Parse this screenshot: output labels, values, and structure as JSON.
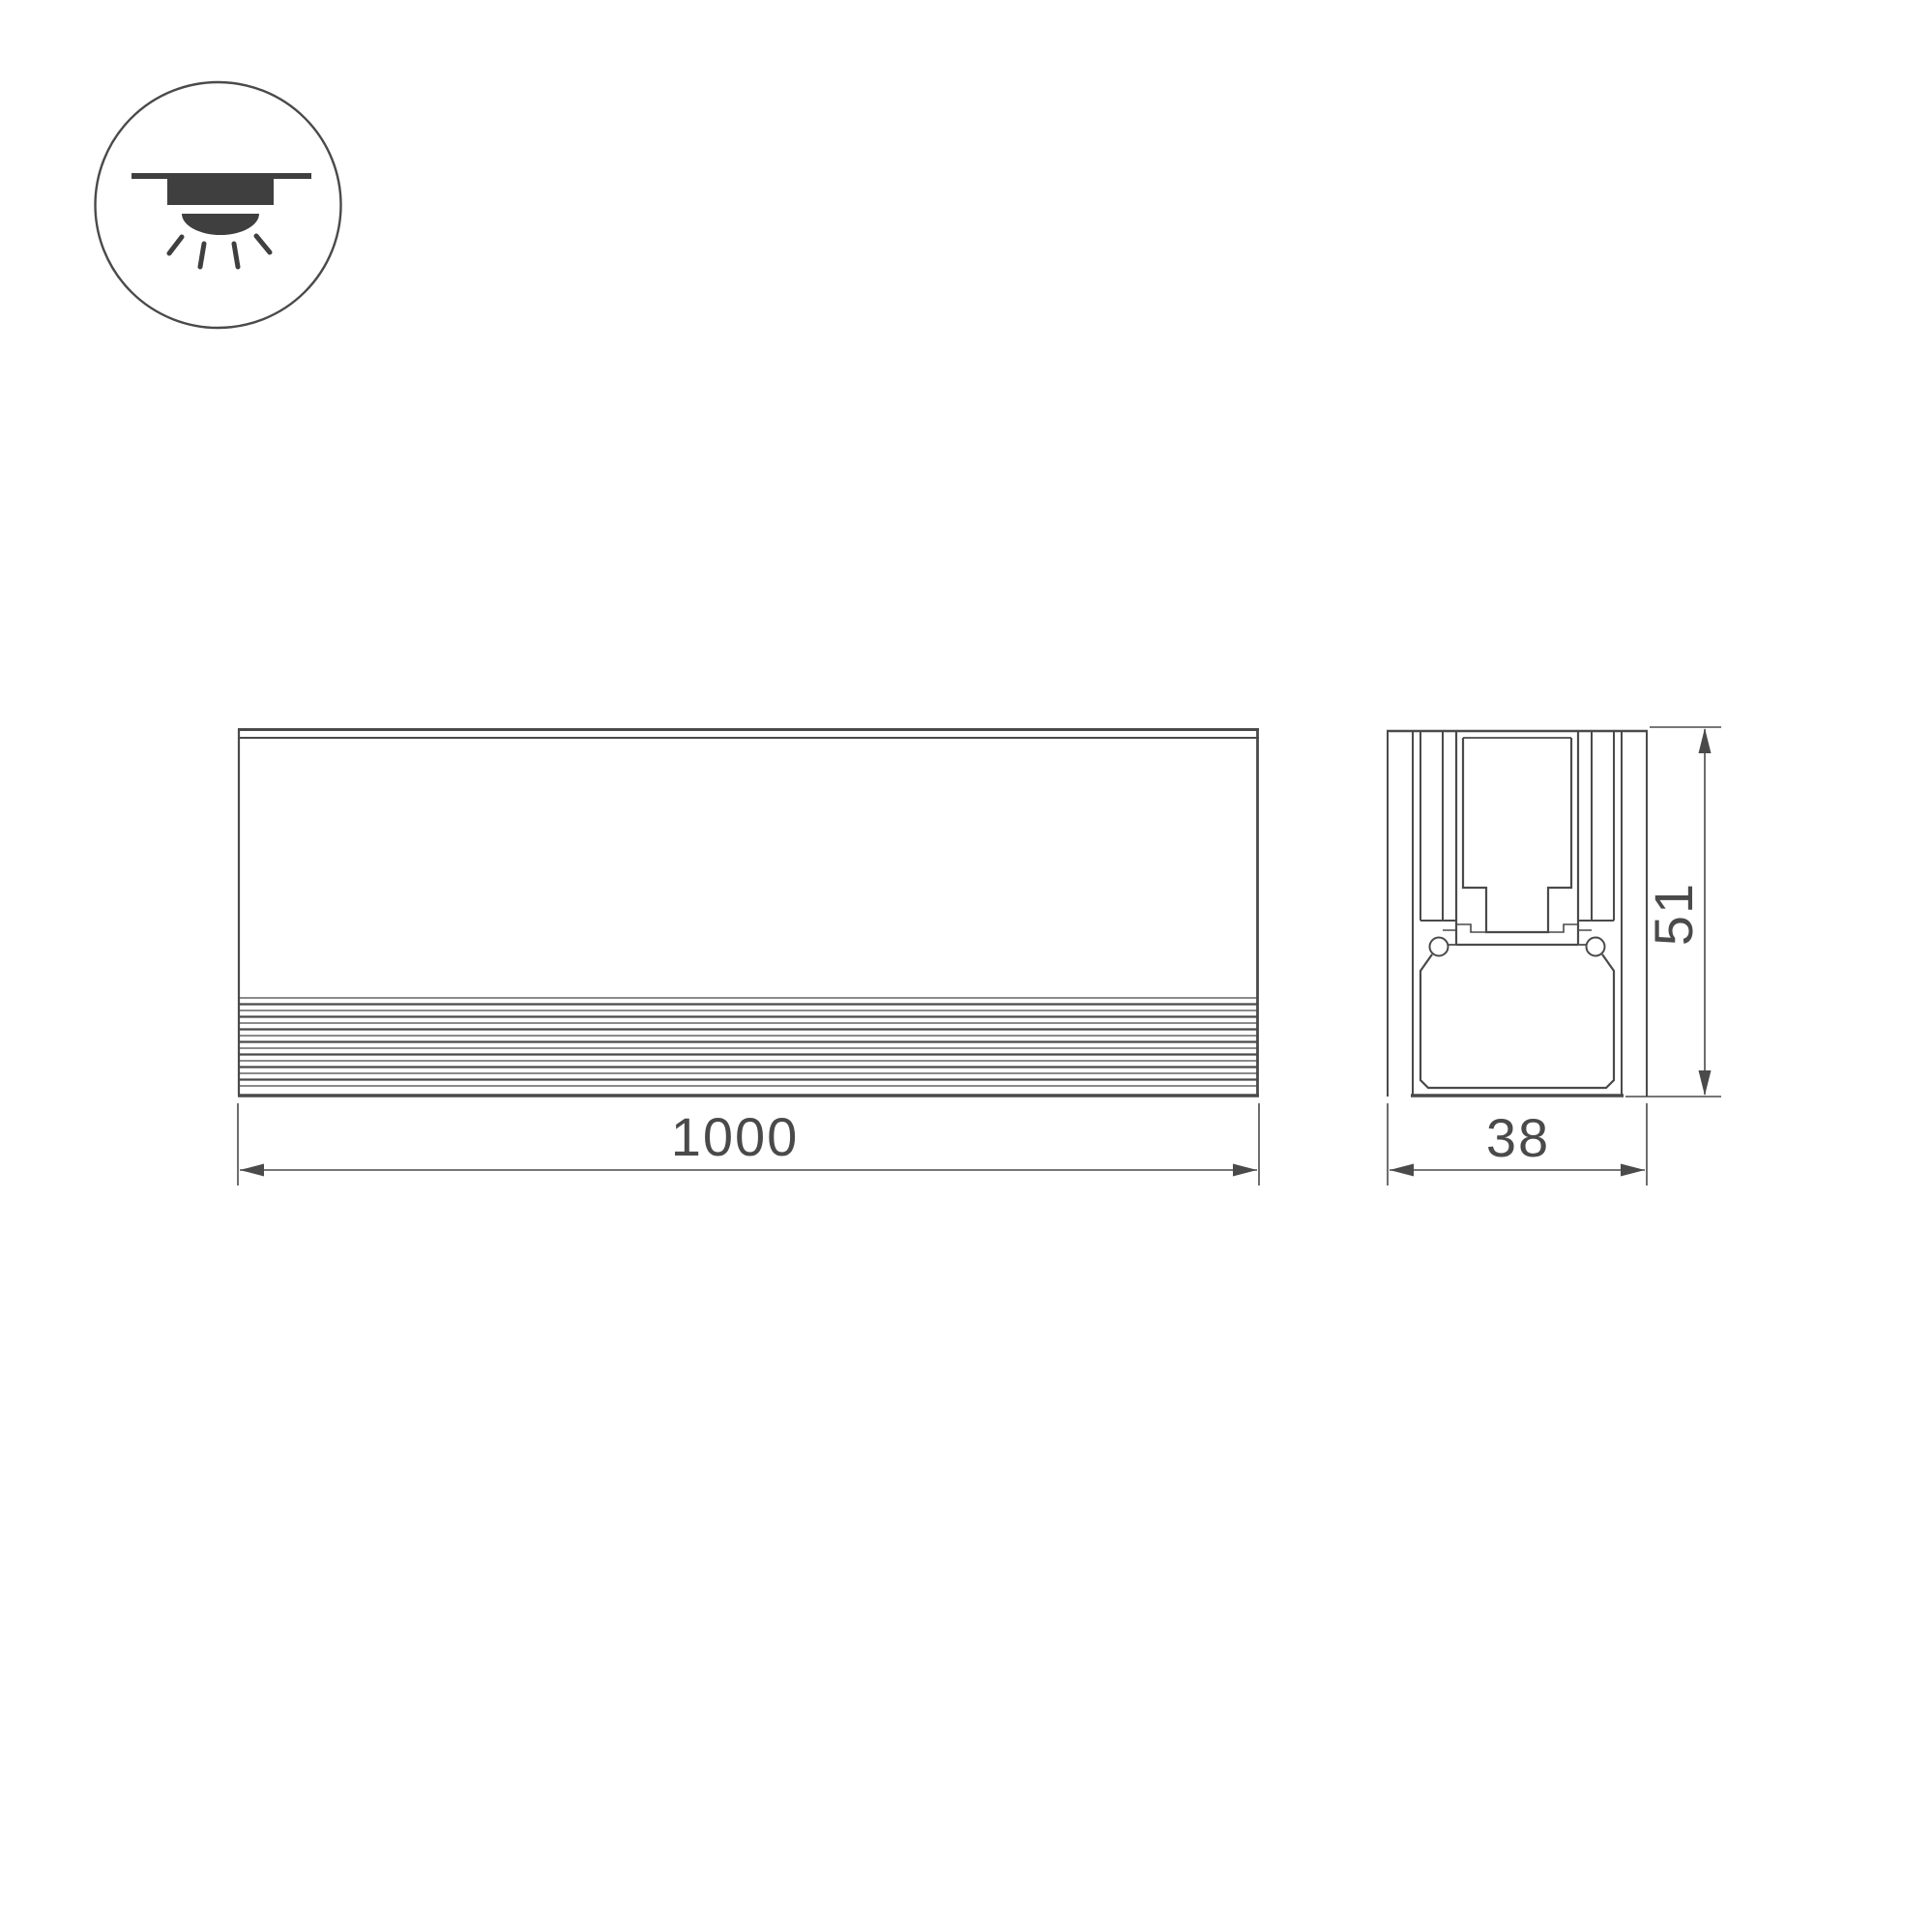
{
  "page": {
    "type": "technical-drawing"
  },
  "colors": {
    "background": "#ffffff",
    "line": "#4a4a4a",
    "fill": "#3f3f3f",
    "dim": "#4a4a4a"
  },
  "icon": {
    "name": "recessed-downlight"
  },
  "views": {
    "front": {
      "dimension_length": "1000"
    },
    "section": {
      "dimension_width": "38",
      "dimension_height": "51"
    }
  }
}
